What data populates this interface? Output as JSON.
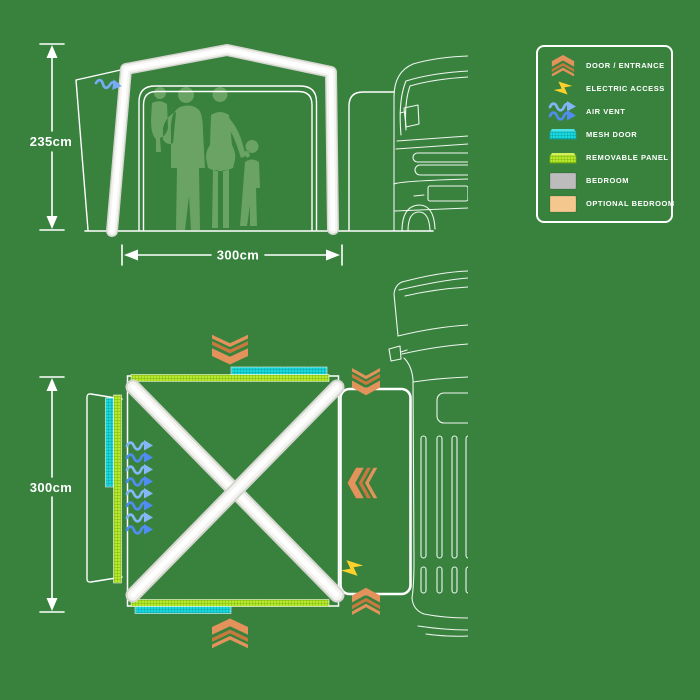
{
  "colors": {
    "background": "#38823E",
    "line_white": "#FFFFFF",
    "silhouette_green": "#6AA364",
    "door_orange": "#E2925A",
    "door_orange_dark": "#C9793D",
    "electric_yellow": "#FFD12A",
    "air_vent_blue_light": "#85B6F8",
    "air_vent_blue": "#4F8DF0",
    "mesh_cyan": "#19D9DC",
    "removable_lime": "#B7EA2E",
    "bedroom_gray": "#BCBCBC",
    "optional_bedroom_tan": "#F4C78F"
  },
  "front_view": {
    "height_label": "235cm",
    "width_label": "300cm"
  },
  "plan_view": {
    "depth_label": "300cm",
    "icons": [
      {
        "type": "door-entrance",
        "position": "top"
      },
      {
        "type": "door-entrance",
        "position": "bottom"
      },
      {
        "type": "door-entrance",
        "position": "tunnel-top"
      },
      {
        "type": "door-entrance",
        "position": "tunnel-bottom"
      },
      {
        "type": "door-entrance",
        "position": "tunnel-right"
      },
      {
        "type": "electric-access",
        "position": "tunnel-bottom-left"
      },
      {
        "type": "air-vent",
        "position": "left-side"
      },
      {
        "type": "mesh-door",
        "position": "top-left-bottom-edges"
      },
      {
        "type": "removable-panel",
        "position": "top-left-bottom-edges"
      }
    ]
  },
  "legend": {
    "items": [
      {
        "icon": "door-entrance-icon",
        "label": "DOOR / ENTRANCE"
      },
      {
        "icon": "electric-access-icon",
        "label": "ELECTRIC ACCESS"
      },
      {
        "icon": "air-vent-icon",
        "label": "AIR VENT"
      },
      {
        "icon": "mesh-door-icon",
        "label": "MESH DOOR"
      },
      {
        "icon": "removable-panel-icon",
        "label": "REMOVABLE PANEL"
      },
      {
        "icon": "bedroom-icon",
        "label": "BEDROOM"
      },
      {
        "icon": "optional-bedroom-icon",
        "label": "OPTIONAL BEDROOM"
      }
    ]
  }
}
